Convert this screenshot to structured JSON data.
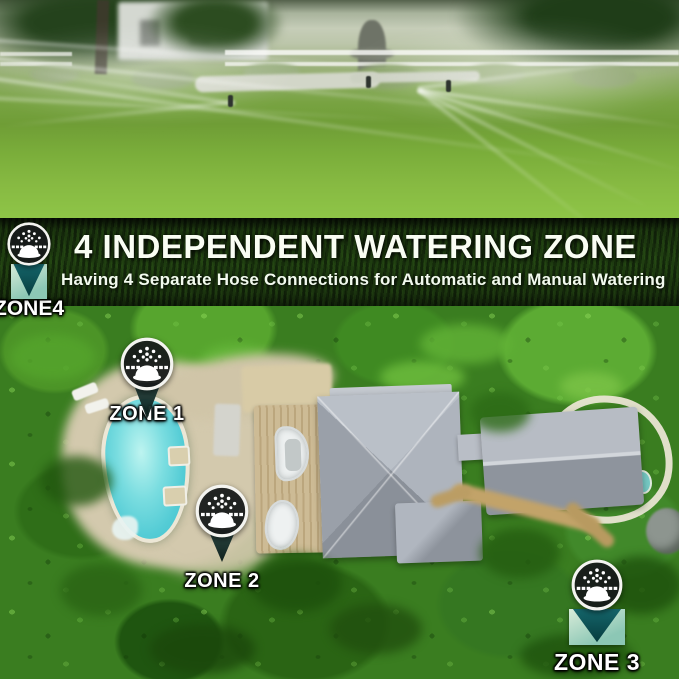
{
  "banner": {
    "headline": "4 INDEPENDENT WATERING ZONE",
    "subtitle": "Having 4 Separate Hose Connections for Automatic and Manual Watering"
  },
  "zones": [
    {
      "id": "zone-1",
      "label": "ZONE 1"
    },
    {
      "id": "zone-2",
      "label": "ZONE 2"
    },
    {
      "id": "zone-3",
      "label": "ZONE 3"
    },
    {
      "id": "zone-4",
      "label": "ZONE4"
    }
  ],
  "icons": {
    "marker": "sprinkler-icon"
  },
  "colors": {
    "pool": "#54ccd5",
    "foliage": "#3a7d20",
    "lawn": "#7fb23c",
    "roof": "#a7adb6",
    "deck": "#c8b58e",
    "marker_teal": "#15666b",
    "banner_text": "#ffffff"
  }
}
